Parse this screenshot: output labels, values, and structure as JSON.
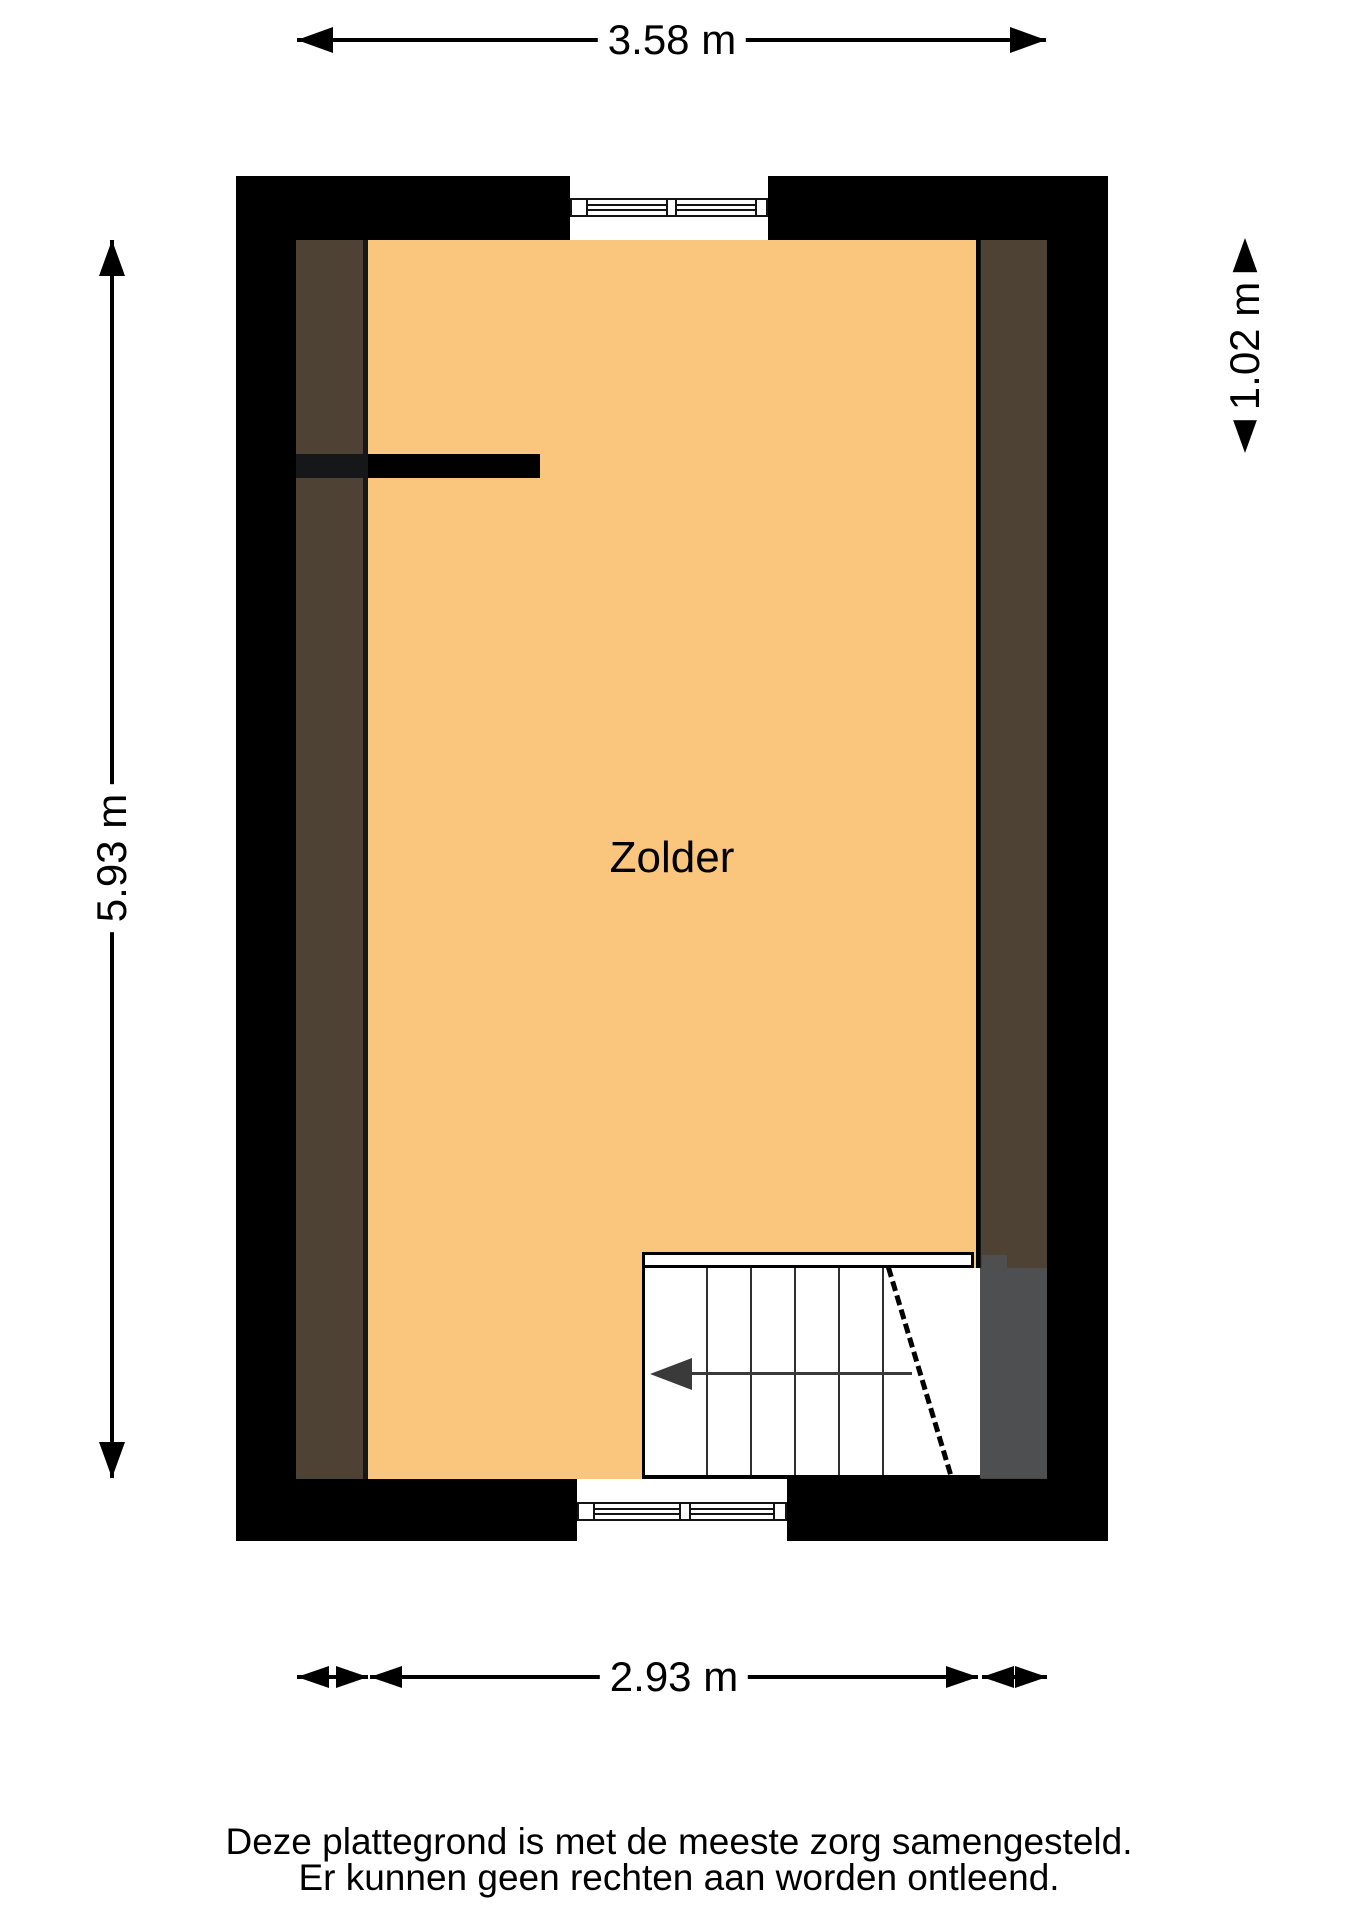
{
  "floorplan": {
    "room_label": "Zolder",
    "dimensions": {
      "width_top": "3.58 m",
      "height_left": "5.93 m",
      "closet_right": "1.02 m",
      "width_bottom": "2.93 m"
    },
    "colors": {
      "floor": "#FAC57D",
      "wall": "#000000",
      "knee_area_overlay": "rgba(28,30,31,0.78)",
      "stair_void": "#4F4F4F",
      "stair_arrow": "#3A3A3A"
    }
  },
  "footer": {
    "line1": "Deze plattegrond is met de meeste zorg samengesteld.",
    "line2": "Er kunnen geen rechten aan worden ontleend."
  }
}
